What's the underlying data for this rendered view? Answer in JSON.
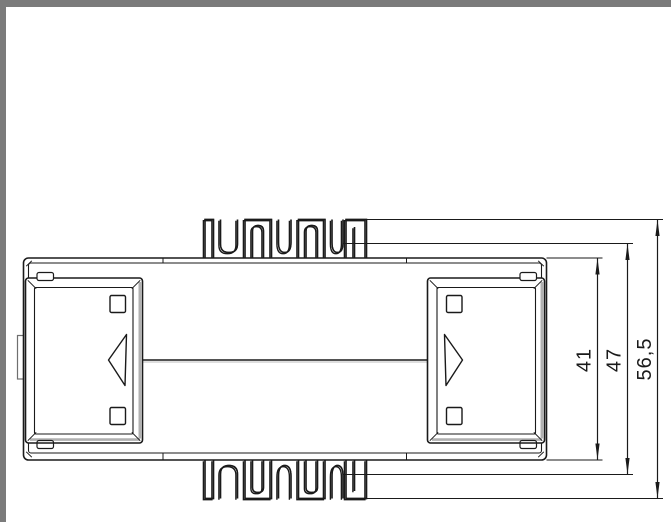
{
  "frame": {
    "border_color": "#7b7b7b",
    "background": "#ffffff"
  },
  "drawing": {
    "view": "housing-side-view-with-din-rail-feet",
    "line_color": "#1a1a1a",
    "shade_color": "#b0b0b0",
    "decimal_separator": ",",
    "dimensions": [
      {
        "label": "41",
        "value": 41,
        "orientation": "vertical"
      },
      {
        "label": "47",
        "value": 47,
        "orientation": "vertical"
      },
      {
        "label": "56,5",
        "value": 56.5,
        "orientation": "vertical"
      }
    ]
  }
}
